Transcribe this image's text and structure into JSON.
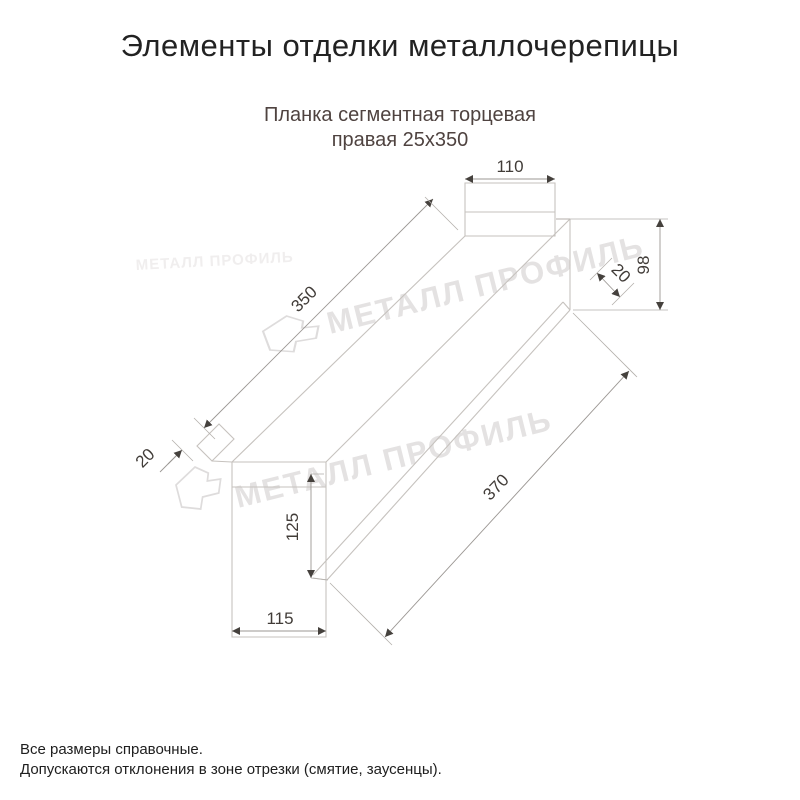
{
  "page": {
    "title": "Элементы отделки металлочерепицы"
  },
  "product": {
    "subtitle_line1": "Планка сегментная торцевая",
    "subtitle_line2": "правая 25х350"
  },
  "drawing": {
    "type": "technical-dimension-drawing",
    "dimensions": {
      "top_end_width": "110",
      "upper_edge_length": "350",
      "left_flange_width": "20",
      "right_end_height": "98",
      "right_flange_width": "20",
      "left_face_height": "125",
      "left_face_width": "115",
      "lower_edge_length": "370"
    },
    "watermark": {
      "text": "МЕТАЛЛ ПРОФИЛЬ",
      "logo": "metal-profil-logo"
    }
  },
  "footer": {
    "line1": "Все размеры справочные.",
    "line2": "Допускаются отклонения в зоне отрезки (смятие, заусенцы)."
  },
  "colors": {
    "title_text": "#222222",
    "subtitle_text": "#4f4340",
    "drawing_lines": "#c6c2be",
    "dimension_text": "#413c38",
    "watermark": "#e4e2e2"
  }
}
